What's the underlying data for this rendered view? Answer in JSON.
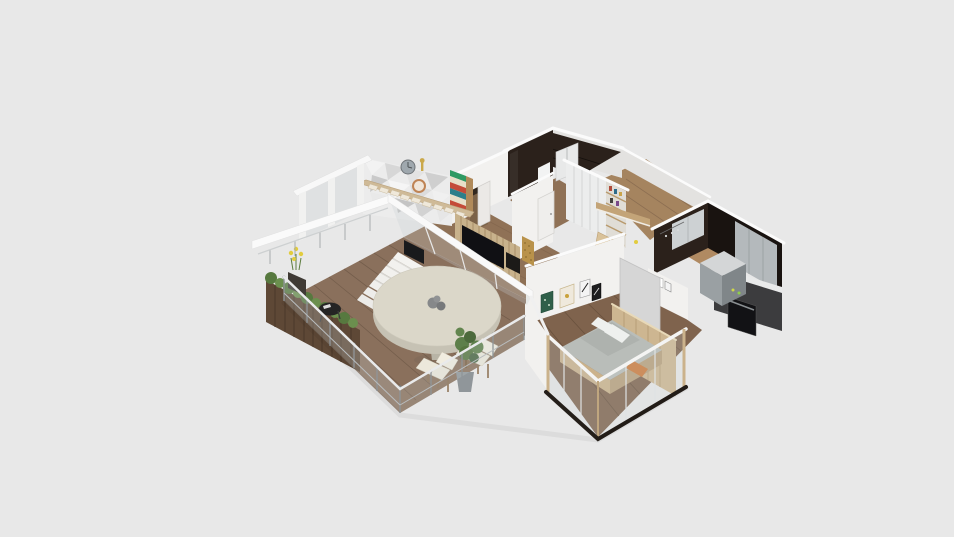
{
  "meta": {
    "kind": "3d-floorplan-render",
    "view": "axonometric-overhead",
    "canvas": {
      "width": 954,
      "height": 537
    },
    "background": "#e8e8e8"
  },
  "palette": {
    "bg": "#e8e8e8",
    "wall-lit": "#fafafa",
    "wall-face": "#f2f1ef",
    "wall-shade": "#e3e2e0",
    "edge-white": "#fbfbfb",
    "wood-floor": "#8f7156",
    "wood-hall": "#a5845f",
    "deck-wood": "#8a705c",
    "dark-tile": "#2b211b",
    "dark-tile-deep": "#191310",
    "kitchen-cab-gray": "#b4b9bc",
    "kitchen-cab-light": "#cdd1d3",
    "island-top": "#d4d6d7",
    "island-front": "#9aa0a3",
    "island-side": "#808689",
    "oven-black": "#121215",
    "tan-wood": "#cdb691",
    "tan-stringer": "#cfba97",
    "tread-cream": "#efe8da",
    "table-top": "#dbd7c9",
    "table-side": "#c6c2b4",
    "pedestal": "#b8b4a6",
    "planter-wood": "#5e4836",
    "planter-line": "#4a3829",
    "hedge-green": "#57793f",
    "hedge-light": "#6b8f4e",
    "flower-yellow": "#e2cc3e",
    "pot-dark": "#3f3a35",
    "pot-gray": "#90969a",
    "plant-green": "#5d7f4a",
    "plant-dark": "#4c6a3c",
    "mattress-gray": "#b9bdb9",
    "pillow-white": "#eef0ee",
    "orange-accent": "#cc7a3c",
    "bed-wood": "#cbb28b",
    "glass-tint": "rgba(200,208,212,0.28)",
    "rail-metal": "#8f9598",
    "rail-white": "#e9eaeb",
    "tv-black": "#101014",
    "slat-wood": "#c8b28c",
    "slat-line": "#a98f68",
    "mosaic-gold": "#b9924a",
    "console-dark": "#1c1a18",
    "door-gray": "#d6d6d6",
    "stripe-green": "#2f9a63",
    "stripe-red": "#c44b38",
    "stripe-teal": "#2d7f8a",
    "stripe-cream": "#e8dfc8",
    "shelf-side": "#b08a5a",
    "clock-gray": "#9fa8ae",
    "clock-copper": "#bf8455",
    "clock-face": "#f0e6da",
    "frame-green": "#2f5f49",
    "frame-beige": "#efe9dc",
    "frame-gold": "#c9a23c",
    "threshold-dark": "#241e19",
    "fireplace-dark": "#191a1c"
  },
  "scene": {
    "rooms": [
      "terrace",
      "living-room",
      "staircase",
      "bathroom",
      "closet-hallway",
      "kitchen",
      "bedroom"
    ],
    "elements": {
      "terrace": [
        "wood-deck",
        "glass-railing",
        "wood-planters",
        "hedge-plants",
        "yellow-flowers",
        "round-dining-table",
        "table-centerpiece",
        "wood-chairs",
        "potted-plant",
        "black-side-table",
        "white-stairs",
        "pergola-beams"
      ],
      "living-room": [
        "geometric-accent-wall",
        "wall-clock-gray",
        "wall-clock-copper",
        "striped-shelf",
        "stair-stringer",
        "tv-slat-wall",
        "tv",
        "fireplace-console",
        "mosaic-panels",
        "glass-sliding-wall"
      ],
      "bathroom": [
        "dark-tile-walls",
        "dark-tile-floor",
        "shower-cabin",
        "sink"
      ],
      "closet-hallway": [
        "sliding-door-wardrobe",
        "open-shelves",
        "wood-console",
        "leaning-panels",
        "white-door"
      ],
      "kitchen": [
        "dark-backsplash-walls",
        "upper-cabinets",
        "tall-gray-cabinet",
        "counter",
        "oven",
        "kitchen-island",
        "hanging-utensils"
      ],
      "bedroom": [
        "wood-floor",
        "picture-frames",
        "bed",
        "orange-pillow",
        "wood-headboard-partition",
        "glass-outer-wall",
        "gray-door-panel"
      ]
    }
  }
}
